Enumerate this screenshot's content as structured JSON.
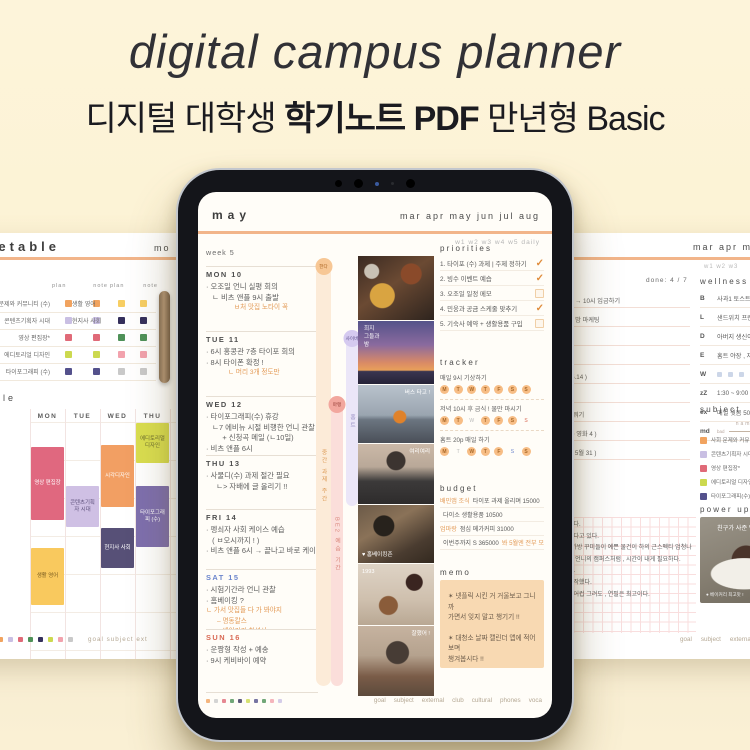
{
  "page": {
    "title": "digital campus planner",
    "subtitle_prefix": "디지털 대학생 ",
    "subtitle_bold": "학기노트 PDF",
    "subtitle_suffix": " 만년형 Basic"
  },
  "colors": {
    "background": "#fcf2d4",
    "accent_line": "#f2b58a",
    "accent_orange": "#e39a56",
    "sat_blue": "#6b85cc",
    "sun_red": "#d96a55",
    "memo_bg": "#f8d9b2"
  },
  "left_page": {
    "title": "timetable",
    "tab_hint": "mo",
    "legend": {
      "col_headers": [
        "plan",
        "note"
      ],
      "left_rows": [
        {
          "label": "사회 문제와 커뮤니티 (수)",
          "color": "c-orange"
        },
        {
          "label": "콘텐츠기획자 시대",
          "color": "c-lilac"
        },
        {
          "label": "영상 편집장*",
          "color": "c-pink"
        },
        {
          "label": "에디토리얼 디자인",
          "color": "c-lime"
        },
        {
          "label": "타이포그래피 (수)",
          "color": "c-navy"
        }
      ],
      "right_rows": [
        {
          "label": "생활 영어",
          "color": "c-yellow"
        },
        {
          "label": "현지사 사회",
          "color": "c-dnavy"
        },
        {
          "label": "",
          "color": "c-green"
        },
        {
          "label": "",
          "color": "c-rose"
        },
        {
          "label": "",
          "color": "c-gray"
        }
      ]
    },
    "schedule": {
      "title": "schedule",
      "days": [
        "MON",
        "TUE",
        "WED",
        "THU",
        "FRI"
      ],
      "blocks": [
        {
          "label": "영상 편집장",
          "color": "b-pink"
        },
        {
          "label": "생활 영어",
          "color": "b-yellow"
        },
        {
          "label": "콘텐츠기획자 시대",
          "color": "b-lilac"
        },
        {
          "label": "시각디자인",
          "color": "b-orange"
        },
        {
          "label": "현지사 사회",
          "color": "b-dnavy"
        },
        {
          "label": "에디토리얼 디자인",
          "color": "b-lime"
        },
        {
          "label": "타이포그래피 (수)",
          "color": "b-purple"
        }
      ]
    },
    "footer": {
      "dots": [
        "c-orange",
        "c-lilac",
        "c-pink",
        "c-green",
        "c-dnavy",
        "c-lime",
        "c-rose",
        "c-gray"
      ],
      "tabs_text": "goal   subject   ext"
    }
  },
  "ipad": {
    "month": "may",
    "month_tabs": "mar apr may jun jul aug",
    "week_tabs": "w1  w2  w3  w4  w5  daily",
    "week_label": "week 5",
    "days": [
      {
        "label": "MON  10",
        "tone": "",
        "notes": [
          "· 오조일 언니 실평 회의",
          "   ㄴ 비츠 앤플 9시 출발"
        ],
        "accents": [
          "ㅂ처 맛집 노타이 꼭"
        ]
      },
      {
        "label": "TUE  11",
        "tone": "",
        "notes": [
          "· 6시 홍콩관 7층 타이포 회의",
          "· 8시 타이폰 확정 !"
        ],
        "accents": [
          "ㄴ 머리 3개 정도만"
        ]
      },
      {
        "label": "WED  12",
        "tone": "",
        "notes": [
          "· 타이포그래피(수) 휴강",
          "   ㄴ7 에비뉴 시절 비행한 언니 관찰",
          "        + 신청곡 메일 (ㄴ10일)",
          "· 비츠 앤플 6시"
        ],
        "accents": []
      },
      {
        "label": "THU  13",
        "tone": "",
        "notes": [
          "· 사물디(수) 과제 절간 필요",
          "     ㄴ> 자배에 글 올리기 !!"
        ],
        "accents": []
      },
      {
        "label": "FRI  14",
        "tone": "",
        "notes": [
          "· 펭쇠자 사회 케이스 예습",
          "   ( ㅂ오시까지 ! )",
          "· 비츠 앤플 6시 → 끝나고 바로 케이스…"
        ],
        "accents": []
      },
      {
        "label": "SAT  15",
        "tone": "sat",
        "notes": [
          "· 시험기간라 언니 관찰",
          "· 홈베이킹 ?"
        ],
        "accents": [
          "ㄴ 가서 맛집들 다 가 봐야지",
          "      – 명동칼스",
          "      – 베이커리 칠성사"
        ]
      },
      {
        "label": "SUN  16",
        "tone": "sun",
        "notes": [
          "· 운짱형 작성 + 예송",
          "· 9시 케비바이 예약"
        ],
        "accents": []
      }
    ],
    "pills": [
      {
        "badge": "한다",
        "text": "중간 과제 주간",
        "tone": "tone-orange"
      },
      {
        "badge": "마랭",
        "text": "BE2 예습 기간",
        "tone": "tone-red"
      },
      {
        "badge": "사이버",
        "text": "홈트",
        "tone": "tone-purple"
      }
    ],
    "photos": [
      {
        "name": "dinner-table-photo",
        "overlay": ""
      },
      {
        "name": "sunset-photo",
        "overlay": "희지\n그들과\n밤"
      },
      {
        "name": "rooftop-photo",
        "overlay": "버스 타고 !"
      },
      {
        "name": "portrait-photo",
        "overlay": "여리여리"
      },
      {
        "name": "cafe-photo",
        "overlay": "♥ 홈베이킹존"
      },
      {
        "name": "dessert-photo",
        "overlay": "1993"
      },
      {
        "name": "selfie-photo",
        "overlay": "잘했어 !"
      }
    ],
    "priorities": {
      "title": "priorities",
      "items": [
        {
          "text": "1.  타이포 (수) 과제 | 주제 정하기",
          "state": "chk-on"
        },
        {
          "text": "2.  빙수 이벤트 예습",
          "state": "chk-on"
        },
        {
          "text": "3.  오조일 일정 메모",
          "state": "chk-off"
        },
        {
          "text": "4.  민웅과 공금 스케줄 맞추기",
          "state": "chk-on"
        },
        {
          "text": "5.  기숙사 예약 + 생활용품 구입",
          "state": "chk-off"
        }
      ]
    },
    "tracker": {
      "title": "tracker",
      "habits": [
        {
          "label": "매일 9시 기상하기",
          "days": [
            {
              "d": "M",
              "state": "on"
            },
            {
              "d": "T",
              "state": "on"
            },
            {
              "d": "W",
              "state": "on"
            },
            {
              "d": "T",
              "state": "on"
            },
            {
              "d": "F",
              "state": "on"
            },
            {
              "d": "S",
              "state": "on"
            },
            {
              "d": "S",
              "state": "on"
            }
          ]
        },
        {
          "label": "저녁 10시 후 금식 ! 물만 마시기",
          "days": [
            {
              "d": "M",
              "state": "on"
            },
            {
              "d": "T",
              "state": "on"
            },
            {
              "d": "W",
              "state": "off"
            },
            {
              "d": "T",
              "state": "on"
            },
            {
              "d": "F",
              "state": "on"
            },
            {
              "d": "S",
              "state": "on"
            },
            {
              "d": "S",
              "state": "off-red"
            }
          ]
        },
        {
          "label": "홈트 20p 매일 하기",
          "days": [
            {
              "d": "M",
              "state": "on"
            },
            {
              "d": "T",
              "state": "off"
            },
            {
              "d": "W",
              "state": "on"
            },
            {
              "d": "T",
              "state": "on"
            },
            {
              "d": "F",
              "state": "on"
            },
            {
              "d": "S",
              "state": "off-blue"
            },
            {
              "d": "S",
              "state": "on"
            }
          ]
        }
      ]
    },
    "budget": {
      "title": "budget",
      "rows": [
        {
          "pre": "배민앱 조식",
          "text": "타이포 과제 올리며 15000",
          "post": ""
        },
        {
          "pre": "",
          "text": "다이소 생활용품 10500",
          "post": ""
        },
        {
          "pre": "엄마랑",
          "text": "점심 메가커피 31000",
          "post": ""
        },
        {
          "pre": "",
          "text": "이번주까지 S  365000",
          "post": "봐 5월엔 전부 모을거야"
        }
      ]
    },
    "memo": {
      "title": "memo",
      "notes": [
        "✶  넷플릭 시킨 거 거울보고 그니까\n가면서 잊지 말고 챙기기 !!",
        "✶  대청소 날짜 캘린더 앱에 적어보며\n챙겨봅시다 !!"
      ]
    },
    "footer": {
      "dots": [
        "c-orange",
        "c-gray",
        "c-pink",
        "c-green",
        "c-dnavy",
        "c-lime",
        "c-navy",
        "c-green",
        "c-rose",
        "c-lilac"
      ],
      "tabs": [
        "goal",
        "subject",
        "external",
        "club",
        "cultural",
        "phones",
        "voca"
      ]
    }
  },
  "right_page": {
    "month_tabs": "mar apr may ju",
    "week_tabs": "w1  w2  w3",
    "done_label": "done: 4 / 7",
    "checklist": [
      "원어 → 10시 입금하기",
      "플랜 밤 마케팅",
      "메모",
      "",
      "( ~ 5.14 )",
      "",
      "3시 뭐기",
      "2 ( ~ 영화 4 )",
      "( ( ~ 5월 31 )"
    ],
    "wellness": {
      "title": "wellness",
      "rows": [
        {
          "k": "B",
          "v": "사과1 토스트"
        },
        {
          "k": "L",
          "v": "샌드위치 프렌치 토스트"
        },
        {
          "k": "D",
          "v": "아버지 생신이라 분식 뽀개기"
        },
        {
          "k": "E",
          "v": "홈트 야장 , 자료 , 메일"
        }
      ],
      "water_key": "W",
      "water": [
        "on",
        "on",
        "on",
        "on",
        "on",
        "off",
        "off",
        "off"
      ],
      "sleep_key": "zZ",
      "sleep": "1:30 ~ 9:00 ( 7h 30 )",
      "ex_key": "ex",
      "ex": "매일 윗몸 50분",
      "mood_key": "md",
      "mood_left": "bad"
    },
    "subject": {
      "title": "subject",
      "name_header": "name",
      "left_rows": [
        {
          "label": "사회 문제와 커뮤니티(수)",
          "color": "c-orange"
        },
        {
          "label": "콘텐츠기획자 시대",
          "color": "c-lilac"
        },
        {
          "label": "영상 편집장*",
          "color": "c-pink"
        },
        {
          "label": "에디토리얼 디자인",
          "color": "c-lime"
        },
        {
          "label": "타이포그래피(수)",
          "color": "c-navy"
        }
      ],
      "right_rows": [
        {
          "label": "생활 영어",
          "color": "c-yellow"
        },
        {
          "label": "현지사 사회",
          "color": "c-dnavy"
        },
        {
          "label": "",
          "color": "c-green"
        },
        {
          "label": "",
          "color": "c-rose"
        },
        {
          "label": "",
          "color": "c-gray"
        }
      ]
    },
    "power_up": {
      "title": "power up",
      "overlay": "친구가 사준 명장 케이크",
      "caption": "● 베이커리 최고맛 !"
    },
    "notes": [
      "뻔다.",
      "하다고 있다.",
      ": 가방 꾸미들이 예쁜 물건이 하의 근스펙티 엄청나다!",
      "그 언니의 캠퍼스처럼 , 시간이 내게 필요하다.",
      "다.",
      "시작했다.",
      "물어컵 그려도 , 연필은 최고이다."
    ],
    "footer_tabs": [
      "goal",
      "subject",
      "external",
      "club",
      "cultural"
    ]
  }
}
